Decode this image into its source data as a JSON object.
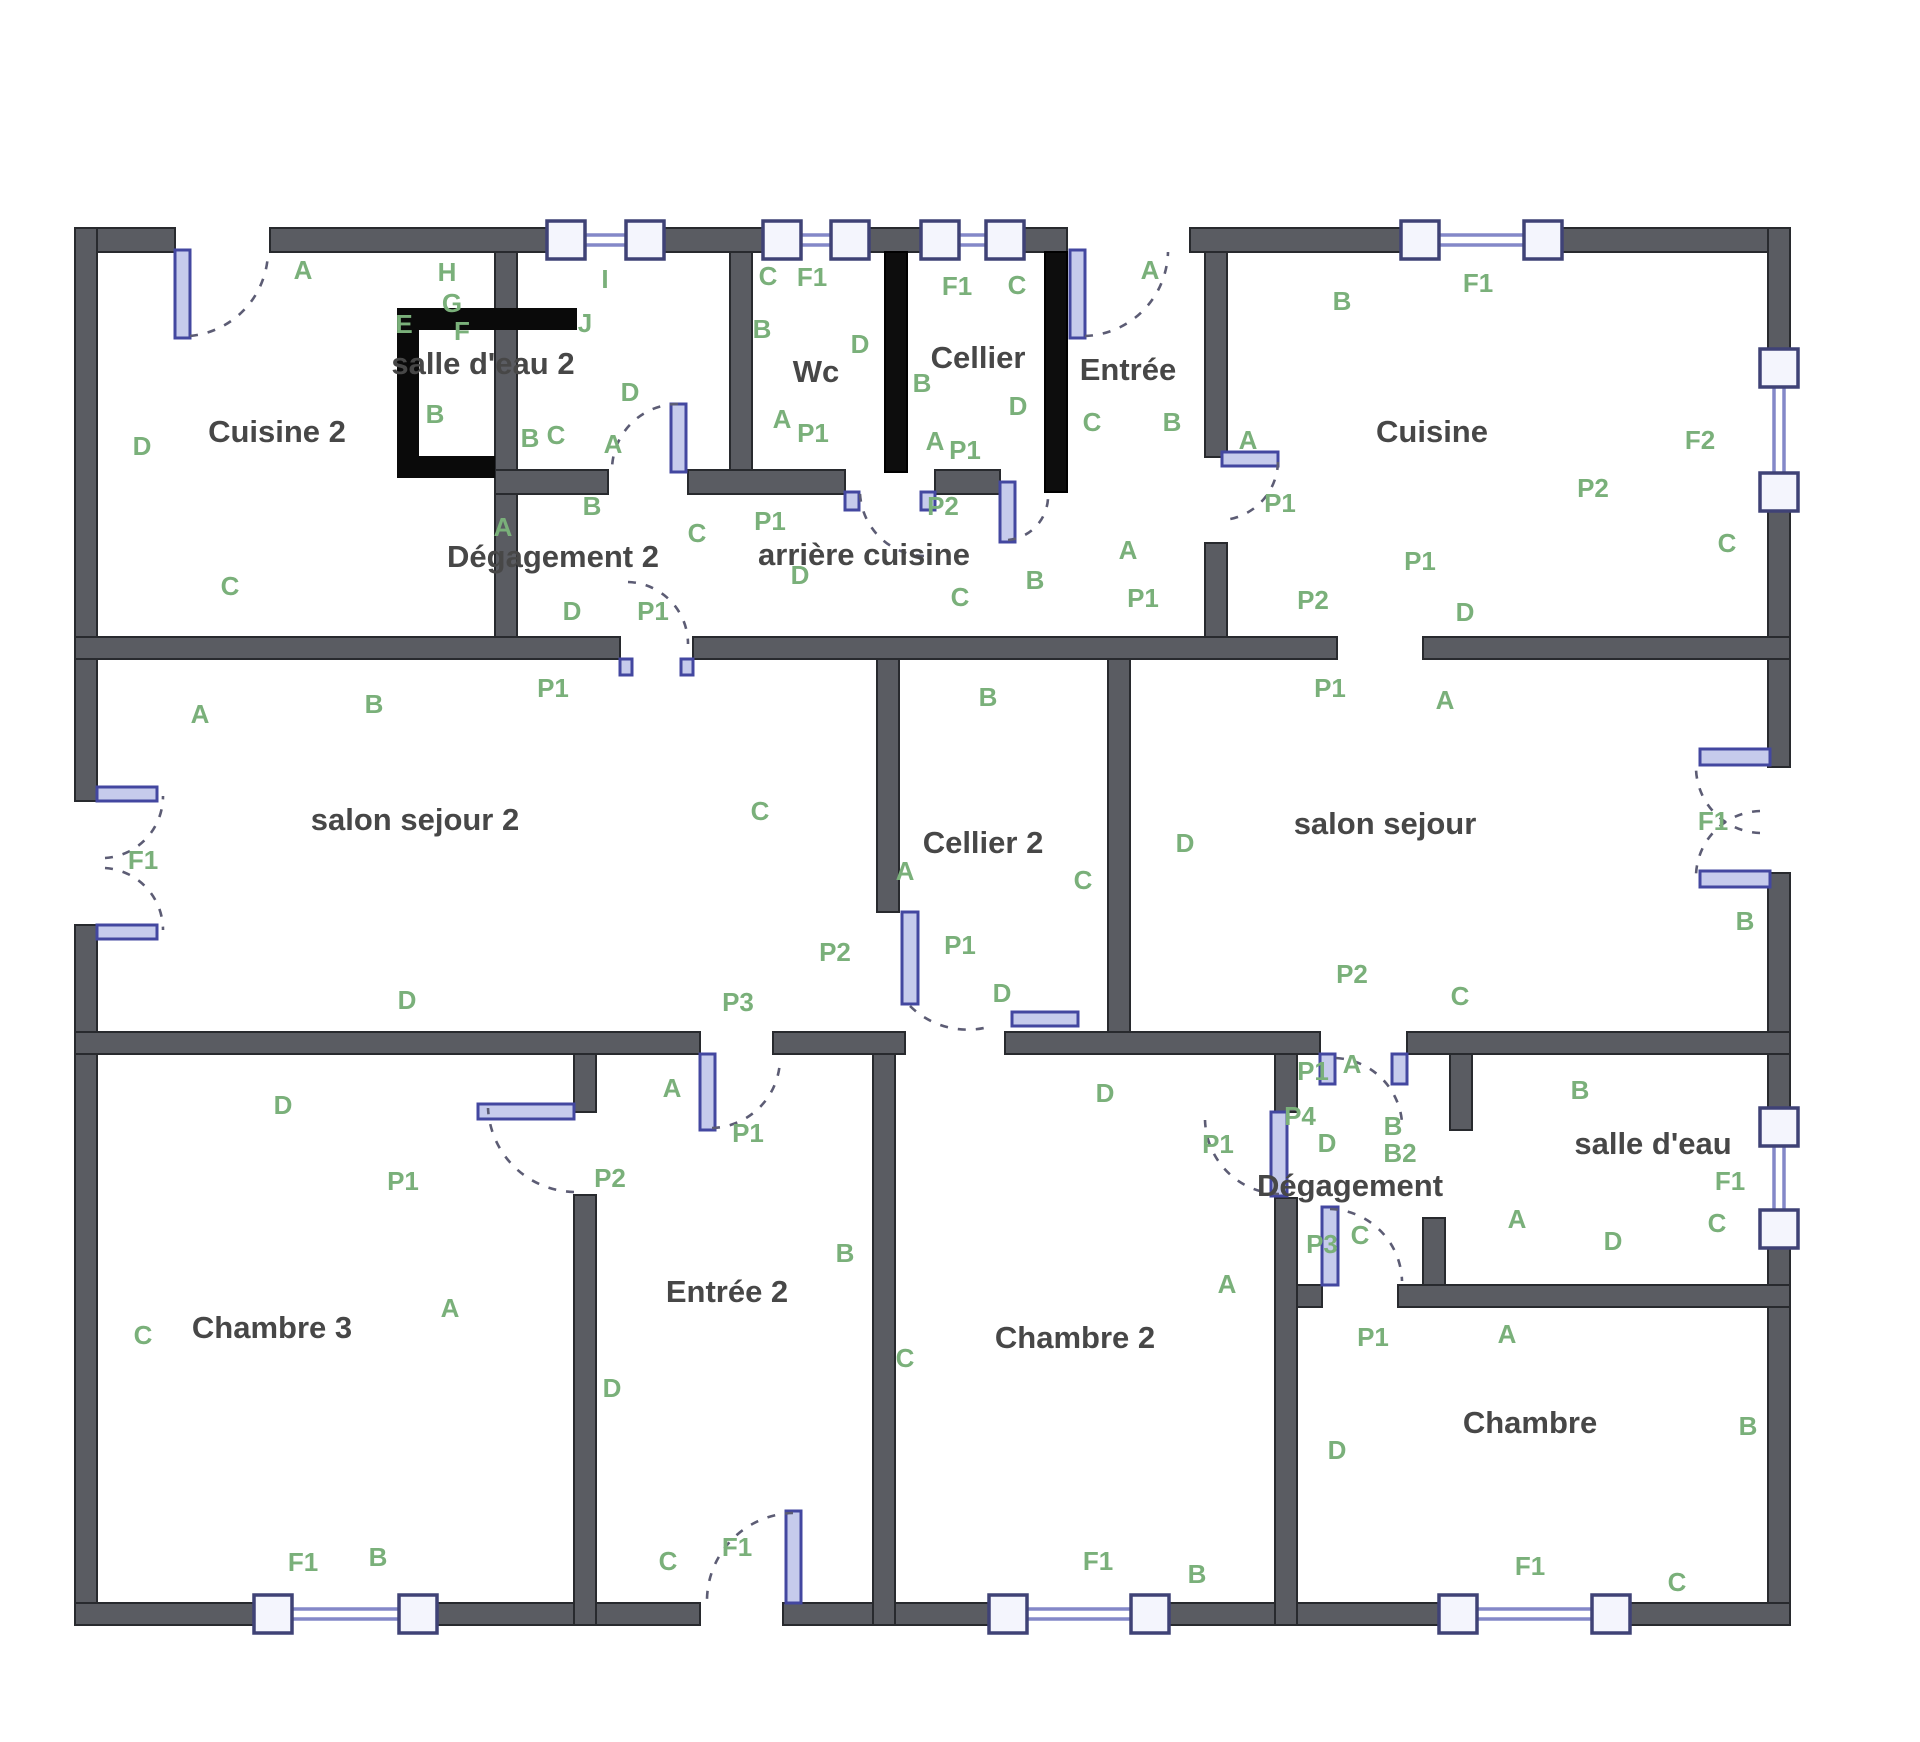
{
  "canvas": {
    "width": 1920,
    "height": 1742,
    "background": "#ffffff"
  },
  "colors": {
    "wall": "#5a5c62",
    "wall_dark": "#0d0d0d",
    "wall_stroke": "#282a2e",
    "window_frame": "#3f4276",
    "window_rail": "#8488c8",
    "window_fill": "#f4f5fd",
    "door_leaf": "#c6cbec",
    "door_leaf_stroke": "#4347a0",
    "door_arc": "#5c5c74",
    "zone_label": "#7ab07a",
    "room_label": "#474747",
    "fixture": "#0a0a0a"
  },
  "rooms": [
    {
      "t": "Cuisine 2",
      "x": 277,
      "y": 434
    },
    {
      "t": "salle d'eau 2",
      "x": 483,
      "y": 366
    },
    {
      "t": "Wc",
      "x": 816,
      "y": 374
    },
    {
      "t": "Cellier",
      "x": 978,
      "y": 360
    },
    {
      "t": "Entrée",
      "x": 1128,
      "y": 372
    },
    {
      "t": "Cuisine",
      "x": 1432,
      "y": 434
    },
    {
      "t": "arrière cuisine",
      "x": 864,
      "y": 557
    },
    {
      "t": "Dégagement 2",
      "x": 553,
      "y": 559
    },
    {
      "t": "salon sejour 2",
      "x": 415,
      "y": 822
    },
    {
      "t": "Cellier 2",
      "x": 983,
      "y": 845
    },
    {
      "t": "salon sejour",
      "x": 1385,
      "y": 826
    },
    {
      "t": "Chambre 3",
      "x": 272,
      "y": 1330
    },
    {
      "t": "Entrée 2",
      "x": 727,
      "y": 1294
    },
    {
      "t": "Chambre 2",
      "x": 1075,
      "y": 1340
    },
    {
      "t": "Dégagement",
      "x": 1350,
      "y": 1188
    },
    {
      "t": "salle d'eau",
      "x": 1653,
      "y": 1146
    },
    {
      "t": "Chambre",
      "x": 1530,
      "y": 1425
    }
  ],
  "zone_labels": [
    {
      "t": "A",
      "x": 303,
      "y": 272
    },
    {
      "t": "H",
      "x": 447,
      "y": 274
    },
    {
      "t": "G",
      "x": 452,
      "y": 305
    },
    {
      "t": "E",
      "x": 404,
      "y": 326
    },
    {
      "t": "F",
      "x": 462,
      "y": 333
    },
    {
      "t": "I",
      "x": 605,
      "y": 281
    },
    {
      "t": "J",
      "x": 585,
      "y": 325
    },
    {
      "t": "D",
      "x": 630,
      "y": 394
    },
    {
      "t": "B",
      "x": 435,
      "y": 416
    },
    {
      "t": "B",
      "x": 530,
      "y": 440
    },
    {
      "t": "C",
      "x": 556,
      "y": 437
    },
    {
      "t": "A",
      "x": 613,
      "y": 446
    },
    {
      "t": "C",
      "x": 768,
      "y": 278
    },
    {
      "t": "F1",
      "x": 812,
      "y": 279
    },
    {
      "t": "B",
      "x": 762,
      "y": 331
    },
    {
      "t": "D",
      "x": 860,
      "y": 346
    },
    {
      "t": "A",
      "x": 782,
      "y": 421
    },
    {
      "t": "P1",
      "x": 813,
      "y": 435
    },
    {
      "t": "F1",
      "x": 957,
      "y": 288
    },
    {
      "t": "C",
      "x": 1017,
      "y": 287
    },
    {
      "t": "B",
      "x": 922,
      "y": 385
    },
    {
      "t": "D",
      "x": 1018,
      "y": 408
    },
    {
      "t": "A",
      "x": 935,
      "y": 443
    },
    {
      "t": "P1",
      "x": 965,
      "y": 452
    },
    {
      "t": "A",
      "x": 1150,
      "y": 272
    },
    {
      "t": "C",
      "x": 1092,
      "y": 424
    },
    {
      "t": "B",
      "x": 1172,
      "y": 424
    },
    {
      "t": "A",
      "x": 1248,
      "y": 442
    },
    {
      "t": "P1",
      "x": 1280,
      "y": 505
    },
    {
      "t": "B",
      "x": 1342,
      "y": 303
    },
    {
      "t": "F1",
      "x": 1478,
      "y": 285
    },
    {
      "t": "F2",
      "x": 1700,
      "y": 442
    },
    {
      "t": "C",
      "x": 1727,
      "y": 545
    },
    {
      "t": "A",
      "x": 1128,
      "y": 552
    },
    {
      "t": "P1",
      "x": 1143,
      "y": 600
    },
    {
      "t": "P1",
      "x": 1420,
      "y": 563
    },
    {
      "t": "P2",
      "x": 1593,
      "y": 490
    },
    {
      "t": "P2",
      "x": 1313,
      "y": 602
    },
    {
      "t": "D",
      "x": 1465,
      "y": 614
    },
    {
      "t": "P1",
      "x": 1330,
      "y": 690
    },
    {
      "t": "A",
      "x": 1445,
      "y": 702
    },
    {
      "t": "P1",
      "x": 770,
      "y": 523
    },
    {
      "t": "P2",
      "x": 943,
      "y": 508
    },
    {
      "t": "D",
      "x": 800,
      "y": 577
    },
    {
      "t": "C",
      "x": 960,
      "y": 599
    },
    {
      "t": "B",
      "x": 1035,
      "y": 582
    },
    {
      "t": "D",
      "x": 572,
      "y": 613
    },
    {
      "t": "P1",
      "x": 653,
      "y": 613
    },
    {
      "t": "C",
      "x": 697,
      "y": 535
    },
    {
      "t": "A",
      "x": 503,
      "y": 529
    },
    {
      "t": "B",
      "x": 592,
      "y": 508
    },
    {
      "t": "C",
      "x": 230,
      "y": 588
    },
    {
      "t": "D",
      "x": 142,
      "y": 448
    },
    {
      "t": "A",
      "x": 200,
      "y": 716
    },
    {
      "t": "B",
      "x": 374,
      "y": 706
    },
    {
      "t": "P1",
      "x": 553,
      "y": 690
    },
    {
      "t": "F1",
      "x": 143,
      "y": 862
    },
    {
      "t": "C",
      "x": 760,
      "y": 813
    },
    {
      "t": "B",
      "x": 988,
      "y": 699
    },
    {
      "t": "A",
      "x": 905,
      "y": 873
    },
    {
      "t": "C",
      "x": 1083,
      "y": 882
    },
    {
      "t": "D",
      "x": 1185,
      "y": 845
    },
    {
      "t": "P2",
      "x": 835,
      "y": 954
    },
    {
      "t": "P1",
      "x": 960,
      "y": 947
    },
    {
      "t": "D",
      "x": 1002,
      "y": 995
    },
    {
      "t": "F1",
      "x": 1713,
      "y": 823
    },
    {
      "t": "B",
      "x": 1745,
      "y": 923
    },
    {
      "t": "P2",
      "x": 1352,
      "y": 976
    },
    {
      "t": "C",
      "x": 1460,
      "y": 998
    },
    {
      "t": "D",
      "x": 407,
      "y": 1002
    },
    {
      "t": "P3",
      "x": 738,
      "y": 1004
    },
    {
      "t": "P1",
      "x": 403,
      "y": 1183
    },
    {
      "t": "P2",
      "x": 610,
      "y": 1180
    },
    {
      "t": "A",
      "x": 672,
      "y": 1090
    },
    {
      "t": "P1",
      "x": 748,
      "y": 1135
    },
    {
      "t": "D",
      "x": 283,
      "y": 1107
    },
    {
      "t": "C",
      "x": 143,
      "y": 1337
    },
    {
      "t": "A",
      "x": 450,
      "y": 1310
    },
    {
      "t": "D",
      "x": 612,
      "y": 1390
    },
    {
      "t": "B",
      "x": 845,
      "y": 1255
    },
    {
      "t": "C",
      "x": 668,
      "y": 1563
    },
    {
      "t": "F1",
      "x": 737,
      "y": 1549
    },
    {
      "t": "F1",
      "x": 303,
      "y": 1564
    },
    {
      "t": "B",
      "x": 378,
      "y": 1559
    },
    {
      "t": "C",
      "x": 905,
      "y": 1360
    },
    {
      "t": "D",
      "x": 1105,
      "y": 1095
    },
    {
      "t": "A",
      "x": 1227,
      "y": 1286
    },
    {
      "t": "F1",
      "x": 1098,
      "y": 1563
    },
    {
      "t": "B",
      "x": 1197,
      "y": 1576
    },
    {
      "t": "P1",
      "x": 1313,
      "y": 1073
    },
    {
      "t": "A",
      "x": 1352,
      "y": 1066
    },
    {
      "t": "P4",
      "x": 1300,
      "y": 1118
    },
    {
      "t": "D",
      "x": 1327,
      "y": 1145
    },
    {
      "t": "B",
      "x": 1393,
      "y": 1128
    },
    {
      "t": "B2",
      "x": 1400,
      "y": 1155
    },
    {
      "t": "P1",
      "x": 1218,
      "y": 1146
    },
    {
      "t": "P3",
      "x": 1322,
      "y": 1246
    },
    {
      "t": "C",
      "x": 1360,
      "y": 1237
    },
    {
      "t": "B",
      "x": 1580,
      "y": 1092
    },
    {
      "t": "F1",
      "x": 1730,
      "y": 1183
    },
    {
      "t": "C",
      "x": 1717,
      "y": 1225
    },
    {
      "t": "A",
      "x": 1517,
      "y": 1221
    },
    {
      "t": "D",
      "x": 1613,
      "y": 1243
    },
    {
      "t": "P1",
      "x": 1373,
      "y": 1339
    },
    {
      "t": "A",
      "x": 1507,
      "y": 1336
    },
    {
      "t": "D",
      "x": 1337,
      "y": 1452
    },
    {
      "t": "B",
      "x": 1748,
      "y": 1428
    },
    {
      "t": "F1",
      "x": 1530,
      "y": 1568
    },
    {
      "t": "C",
      "x": 1677,
      "y": 1584
    }
  ],
  "walls": [
    {
      "x": 75,
      "y": 228,
      "w": 100,
      "h": 24
    },
    {
      "x": 270,
      "y": 228,
      "w": 797,
      "h": 24
    },
    {
      "x": 1190,
      "y": 228,
      "w": 600,
      "h": 24
    },
    {
      "x": 75,
      "y": 228,
      "w": 22,
      "h": 573
    },
    {
      "x": 75,
      "y": 925,
      "w": 22,
      "h": 700
    },
    {
      "x": 1768,
      "y": 228,
      "w": 22,
      "h": 539
    },
    {
      "x": 1768,
      "y": 873,
      "w": 22,
      "h": 740
    },
    {
      "x": 75,
      "y": 1603,
      "w": 625,
      "h": 22
    },
    {
      "x": 783,
      "y": 1603,
      "w": 1007,
      "h": 22
    },
    {
      "x": 495,
      "y": 252,
      "w": 22,
      "h": 407
    },
    {
      "x": 730,
      "y": 252,
      "w": 22,
      "h": 218
    },
    {
      "x": 885,
      "y": 252,
      "w": 22,
      "h": 220,
      "d": 1
    },
    {
      "x": 1045,
      "y": 252,
      "w": 22,
      "h": 240,
      "d": 1
    },
    {
      "x": 1205,
      "y": 252,
      "w": 22,
      "h": 205
    },
    {
      "x": 1205,
      "y": 543,
      "w": 22,
      "h": 94
    },
    {
      "x": 877,
      "y": 659,
      "w": 22,
      "h": 253
    },
    {
      "x": 1108,
      "y": 659,
      "w": 22,
      "h": 395
    },
    {
      "x": 574,
      "y": 1054,
      "w": 22,
      "h": 58
    },
    {
      "x": 574,
      "y": 1195,
      "w": 22,
      "h": 430
    },
    {
      "x": 873,
      "y": 1054,
      "w": 22,
      "h": 571
    },
    {
      "x": 1275,
      "y": 1054,
      "w": 22,
      "h": 58
    },
    {
      "x": 1275,
      "y": 1198,
      "w": 22,
      "h": 427
    },
    {
      "x": 1450,
      "y": 1054,
      "w": 22,
      "h": 76
    },
    {
      "x": 1423,
      "y": 1218,
      "w": 22,
      "h": 89
    },
    {
      "x": 495,
      "y": 470,
      "w": 113,
      "h": 24
    },
    {
      "x": 688,
      "y": 470,
      "w": 157,
      "h": 24
    },
    {
      "x": 935,
      "y": 470,
      "w": 65,
      "h": 24
    },
    {
      "x": 75,
      "y": 637,
      "w": 545,
      "h": 22
    },
    {
      "x": 693,
      "y": 637,
      "w": 644,
      "h": 22
    },
    {
      "x": 1423,
      "y": 637,
      "w": 367,
      "h": 22
    },
    {
      "x": 75,
      "y": 1032,
      "w": 625,
      "h": 22
    },
    {
      "x": 773,
      "y": 1032,
      "w": 132,
      "h": 22
    },
    {
      "x": 1005,
      "y": 1032,
      "w": 315,
      "h": 22
    },
    {
      "x": 1407,
      "y": 1032,
      "w": 383,
      "h": 22
    },
    {
      "x": 1297,
      "y": 1285,
      "w": 25,
      "h": 22
    },
    {
      "x": 1398,
      "y": 1285,
      "w": 392,
      "h": 22
    }
  ],
  "fixtures": [
    {
      "x": 397,
      "y": 308,
      "w": 180,
      "h": 22
    },
    {
      "x": 397,
      "y": 308,
      "w": 22,
      "h": 170
    },
    {
      "x": 397,
      "y": 456,
      "w": 98,
      "h": 22
    }
  ],
  "windows": [
    {
      "o": "h",
      "a": 566,
      "b": 645,
      "c": 240
    },
    {
      "o": "h",
      "a": 782,
      "b": 850,
      "c": 240
    },
    {
      "o": "h",
      "a": 940,
      "b": 1005,
      "c": 240
    },
    {
      "o": "h",
      "a": 1420,
      "b": 1543,
      "c": 240
    },
    {
      "o": "v",
      "a": 368,
      "b": 492,
      "c": 1779
    },
    {
      "o": "v",
      "a": 1127,
      "b": 1229,
      "c": 1779
    },
    {
      "o": "h",
      "a": 273,
      "b": 418,
      "c": 1614
    },
    {
      "o": "h",
      "a": 1008,
      "b": 1150,
      "c": 1614
    },
    {
      "o": "h",
      "a": 1458,
      "b": 1611,
      "c": 1614
    }
  ],
  "door_leaves": [
    {
      "x": 175,
      "y": 250,
      "w": 15,
      "h": 88
    },
    {
      "x": 1070,
      "y": 250,
      "w": 15,
      "h": 88
    },
    {
      "x": 671,
      "y": 404,
      "w": 15,
      "h": 68
    },
    {
      "x": 1000,
      "y": 482,
      "w": 15,
      "h": 60
    },
    {
      "x": 1222,
      "y": 452,
      "w": 56,
      "h": 14
    },
    {
      "x": 620,
      "y": 659,
      "w": 12,
      "h": 16
    },
    {
      "x": 681,
      "y": 659,
      "w": 12,
      "h": 16
    },
    {
      "x": 97,
      "y": 787,
      "w": 60,
      "h": 14
    },
    {
      "x": 97,
      "y": 925,
      "w": 60,
      "h": 14
    },
    {
      "x": 1700,
      "y": 749,
      "w": 70,
      "h": 16
    },
    {
      "x": 1700,
      "y": 871,
      "w": 70,
      "h": 16
    },
    {
      "x": 902,
      "y": 912,
      "w": 16,
      "h": 92
    },
    {
      "x": 1012,
      "y": 1012,
      "w": 66,
      "h": 14
    },
    {
      "x": 700,
      "y": 1054,
      "w": 15,
      "h": 76
    },
    {
      "x": 478,
      "y": 1104,
      "w": 96,
      "h": 15
    },
    {
      "x": 1320,
      "y": 1054,
      "w": 15,
      "h": 30
    },
    {
      "x": 1392,
      "y": 1054,
      "w": 15,
      "h": 30
    },
    {
      "x": 1271,
      "y": 1112,
      "w": 16,
      "h": 84
    },
    {
      "x": 1322,
      "y": 1207,
      "w": 16,
      "h": 78
    },
    {
      "x": 786,
      "y": 1511,
      "w": 15,
      "h": 92
    },
    {
      "x": 845,
      "y": 492,
      "w": 14,
      "h": 18
    },
    {
      "x": 921,
      "y": 492,
      "w": 14,
      "h": 18
    }
  ],
  "door_arcs": [
    {
      "m": [
        190,
        336
      ],
      "r": 86,
      "e": [
        268,
        252
      ],
      "s": 0
    },
    {
      "m": [
        1085,
        336
      ],
      "r": 86,
      "e": [
        1168,
        252
      ],
      "s": 0
    },
    {
      "m": [
        678,
        404
      ],
      "r": 66,
      "e": [
        612,
        470
      ],
      "s": 0
    },
    {
      "m": [
        1008,
        540
      ],
      "r": 44,
      "e": [
        1048,
        494
      ],
      "s": 0
    },
    {
      "m": [
        1278,
        462
      ],
      "r": 60,
      "e": [
        1224,
        520
      ],
      "s": 1
    },
    {
      "m": [
        628,
        582
      ],
      "r": 62,
      "e": [
        688,
        644
      ],
      "s": 1
    },
    {
      "m": [
        105,
        858
      ],
      "r": 62,
      "e": [
        163,
        796
      ],
      "s": 0
    },
    {
      "m": [
        105,
        868
      ],
      "r": 62,
      "e": [
        163,
        930
      ],
      "s": 1
    },
    {
      "m": [
        1760,
        833
      ],
      "r": 66,
      "e": [
        1696,
        767
      ],
      "s": 1
    },
    {
      "m": [
        1760,
        811
      ],
      "r": 66,
      "e": [
        1696,
        877
      ],
      "s": 0
    },
    {
      "m": [
        910,
        1006
      ],
      "r": 82,
      "e": [
        984,
        1028
      ],
      "s": 0
    },
    {
      "m": [
        712,
        1128
      ],
      "r": 70,
      "e": [
        780,
        1058
      ],
      "s": 0
    },
    {
      "m": [
        574,
        1192
      ],
      "r": 88,
      "e": [
        488,
        1108
      ],
      "s": 1
    },
    {
      "m": [
        1336,
        1058
      ],
      "r": 70,
      "e": [
        1402,
        1122
      ],
      "s": 1
    },
    {
      "m": [
        1279,
        1194
      ],
      "r": 76,
      "e": [
        1205,
        1120
      ],
      "s": 1
    },
    {
      "m": [
        1330,
        1209
      ],
      "r": 74,
      "e": [
        1402,
        1281
      ],
      "s": 1
    },
    {
      "m": [
        793,
        1513
      ],
      "r": 88,
      "e": [
        707,
        1599
      ],
      "s": 0
    },
    {
      "m": [
        924,
        556
      ],
      "r": 66,
      "e": [
        860,
        494
      ],
      "s": 1
    }
  ]
}
